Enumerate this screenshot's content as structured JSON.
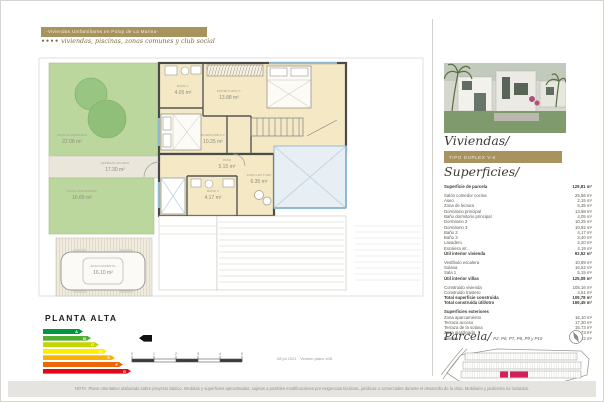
{
  "header": {
    "title": "-Viviendas Unifamiliares en Polop de La Marina-",
    "brand_dots": "••••",
    "subtitle": "viviendas, piscinas, zonas comunes y club social",
    "accent_gold": "#a8935f"
  },
  "plan": {
    "title": "PLANTA ALTA",
    "rooms": [
      {
        "name": "ZONA AJARDINADA",
        "area": "22.08 m²"
      },
      {
        "name": "TERRAZA ACCESO",
        "area": "17.30 m²"
      },
      {
        "name": "ZONA AJARDINADA",
        "area": "16.65 m²"
      },
      {
        "name": "APARCAMIENTO",
        "area": "16.10 m²"
      },
      {
        "name": "BAÑO 1",
        "area": "4.05 m²"
      },
      {
        "name": "DORMITORIO P.",
        "area": "13.88 m²"
      },
      {
        "name": "DORMITORIO 2",
        "area": "10.25 m²"
      },
      {
        "name": "PASO",
        "area": "5.15 m²"
      },
      {
        "name": "ZONA LECTURA",
        "area": "6.35 m²"
      },
      {
        "name": "BAÑO 2",
        "area": "4.17 m²"
      }
    ],
    "scale_ticks": [
      "0",
      "1",
      "2",
      "3",
      "4",
      "5"
    ],
    "version_note": "08 jul 2021 · Versión plano v06"
  },
  "energy_label": {
    "levels": [
      {
        "letter": "A",
        "color": "#009641"
      },
      {
        "letter": "B",
        "color": "#52ae32"
      },
      {
        "letter": "C",
        "color": "#c8d400"
      },
      {
        "letter": "D",
        "color": "#ffed00"
      },
      {
        "letter": "E",
        "color": "#f9b000"
      },
      {
        "letter": "F",
        "color": "#ec6608"
      },
      {
        "letter": "G",
        "color": "#e30613"
      }
    ],
    "current_index": 1
  },
  "sidebar": {
    "viviendas_title": "Viviendas/",
    "tipo_badge": "Tipo duplex v-6",
    "superficies_title": "Superficies/",
    "parcela_title": "Parcela/",
    "parcela_plots": "P2, P6, P7, P8, P9 y P10",
    "parcela_highlight": "#d0215a",
    "superficies": {
      "sections": [
        {
          "rows": [
            {
              "label": "Superficie de parcela",
              "value": "129,81 m²",
              "bold": true
            }
          ]
        },
        {
          "rows": [
            {
              "label": "Salón comedor cocina",
              "value": "25,56 m²"
            },
            {
              "label": "Aseo",
              "value": "2,15 m²"
            },
            {
              "label": "Zona de lectura",
              "value": "6,35 m²"
            },
            {
              "label": "Dormitorio principal",
              "value": "13,88 m²"
            },
            {
              "label": "Baño dormitorio principal",
              "value": "4,05 m²"
            },
            {
              "label": "Dormitorio 2",
              "value": "10,25 m²"
            },
            {
              "label": "Dormitorio 3",
              "value": "10,92 m²"
            },
            {
              "label": "Baño 2",
              "value": "4,17 m²"
            },
            {
              "label": "Baño 3",
              "value": "3,40 m²"
            },
            {
              "label": "Lavadero",
              "value": "2,20 m²"
            },
            {
              "label": "Escalera int.",
              "value": "4,19 m²"
            },
            {
              "label": "Útil interior vivienda",
              "value": "92,52 m²",
              "bold": true
            }
          ]
        },
        {
          "rows": [
            {
              "label": "Vestíbulo escalera",
              "value": "10,89 m²"
            },
            {
              "label": "Solana",
              "value": "16,52 m²"
            },
            {
              "label": "Sala 1",
              "value": "5,15 m²"
            },
            {
              "label": "Útil interior villas",
              "value": "125,08 m²",
              "bold": true
            }
          ]
        },
        {
          "rows": [
            {
              "label": "Construido vivienda",
              "value": "105,16 m²"
            },
            {
              "label": "Construido trastero",
              "value": "4,51 m²"
            },
            {
              "label": "Total superficie construida",
              "value": "109,78 m²",
              "bold": true
            },
            {
              "label": "Total construida útil/otro",
              "value": "169,45 m²",
              "bold": true
            }
          ]
        },
        {
          "rows": [
            {
              "label": "Superficies exteriores",
              "value": "",
              "bold": true
            },
            {
              "label": "Zona aparcamiento",
              "value": "16,10 m²"
            },
            {
              "label": "Terraza acceso",
              "value": "17,30 m²"
            },
            {
              "label": "Terraza de la solana",
              "value": "15,73 m²"
            },
            {
              "label": "Zona ajardinada",
              "value": "38,73 m²"
            },
            {
              "label": "Piscina",
              "value": "15,22 m²"
            }
          ]
        }
      ]
    }
  },
  "footer": {
    "note": "NOTA: Plano orientativo elaborado sobre proyecto básico. Medidas y superficies aproximadas, sujetas a posibles modificaciones por exigencias técnicas, jurídicas o comerciales durante el desarrollo de la obra. Mobiliario y jardinería no incluidos."
  }
}
